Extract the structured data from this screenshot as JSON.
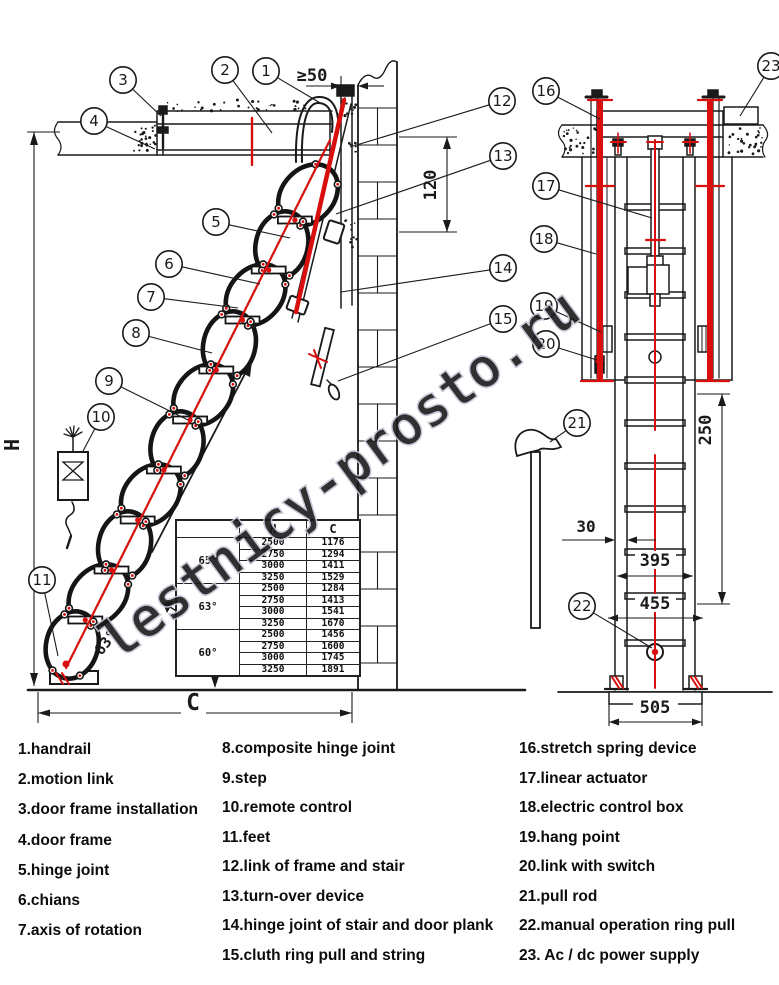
{
  "watermark": "lestnicy-prosto.ru",
  "diagram": {
    "dim_gap": "≥50",
    "dim_offset": "120",
    "dim_height": "H",
    "dim_width": "C",
    "dim_angle": "~63°",
    "dim_spring": "250",
    "dim_stile": "30",
    "dim_inner": "395",
    "dim_outer": "455",
    "dim_base": "505",
    "callout_numbers": [
      "1",
      "2",
      "3",
      "4",
      "5",
      "6",
      "7",
      "8",
      "9",
      "10",
      "11",
      "12",
      "13",
      "14",
      "15",
      "16",
      "17",
      "18",
      "19",
      "20",
      "21",
      "22",
      "23"
    ]
  },
  "size_table": {
    "col_headers": [
      "",
      "H",
      "C"
    ],
    "groups": [
      {
        "angle": "65°",
        "rows": [
          [
            "2500",
            "1176"
          ],
          [
            "2750",
            "1294"
          ],
          [
            "3000",
            "1411"
          ],
          [
            "3250",
            "1529"
          ]
        ]
      },
      {
        "angle": "63°",
        "rows": [
          [
            "2500",
            "1284"
          ],
          [
            "2750",
            "1413"
          ],
          [
            "3000",
            "1541"
          ],
          [
            "3250",
            "1670"
          ]
        ]
      },
      {
        "angle": "60°",
        "rows": [
          [
            "2500",
            "1456"
          ],
          [
            "2750",
            "1600"
          ],
          [
            "3000",
            "1745"
          ],
          [
            "3250",
            "1891"
          ]
        ]
      }
    ]
  },
  "legend": {
    "col1": [
      "1.handrail",
      "2.motion link",
      "3.door frame installation",
      "4.door frame",
      "5.hinge joint",
      "6.chians",
      "7.axis of rotation"
    ],
    "col2": [
      "8.composite hinge joint",
      "9.step",
      "10.remote control",
      "11.feet",
      "12.link of frame and stair",
      "13.turn-over device",
      "14.hinge joint of stair and door plank",
      "15.cluth ring pull and string"
    ],
    "col3": [
      "16.stretch spring device",
      "17.linear actuator",
      "18.electric control box",
      "19.hang point",
      "20.link with switch",
      "21.pull rod",
      "22.manual operation ring pull",
      "23. Ac / dc power supply"
    ]
  }
}
